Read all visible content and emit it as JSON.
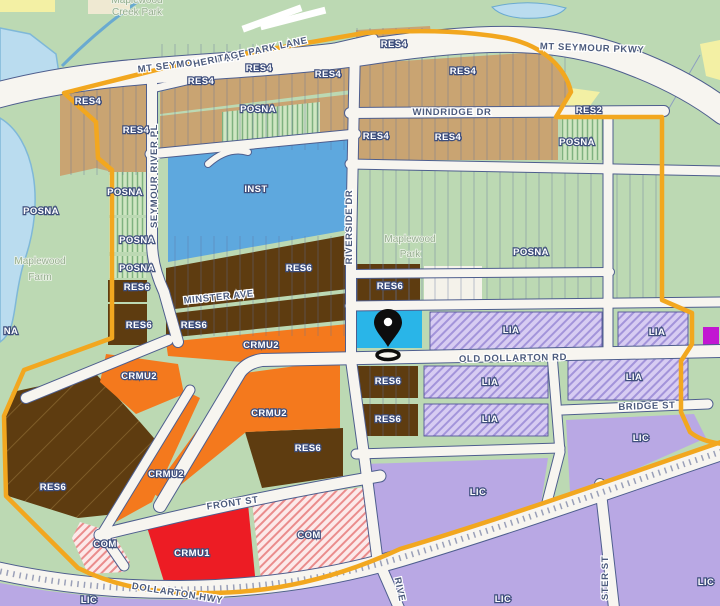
{
  "map": {
    "marker": {
      "name": "selected-parcel-pin",
      "x": 388,
      "y": 325
    },
    "colors": {
      "boundary": "#f2a71f",
      "base_green": "#bcd9b3",
      "water": "#badcef",
      "res4_tan": "#c9a472",
      "inst_blue": "#5ea8de",
      "res6_brown": "#5e3c10",
      "crmu2_orange": "#f4791d",
      "crmu1_red": "#ed1c24",
      "lia_purple": "#d7ccf2",
      "lic_purple": "#b9a8e4",
      "com_pink": "#fce9e9",
      "selected_cyan": "#29b5e8",
      "magenta": "#c217d2",
      "yellow": "#f3f0a4",
      "white_parcel": "#f4f2ea"
    },
    "zone_labels": [
      {
        "t": "RES4",
        "x": 88,
        "y": 104
      },
      {
        "t": "RES4",
        "x": 136,
        "y": 133
      },
      {
        "t": "RES4",
        "x": 201,
        "y": 84
      },
      {
        "t": "RES4",
        "x": 259,
        "y": 71
      },
      {
        "t": "RES4",
        "x": 328,
        "y": 77
      },
      {
        "t": "RES4",
        "x": 394,
        "y": 47
      },
      {
        "t": "RES4",
        "x": 463,
        "y": 74
      },
      {
        "t": "RES4",
        "x": 376,
        "y": 139
      },
      {
        "t": "RES4",
        "x": 448,
        "y": 140
      },
      {
        "t": "RES2",
        "x": 589,
        "y": 113
      },
      {
        "t": "POSNA",
        "x": 258,
        "y": 112
      },
      {
        "t": "POSNA",
        "x": 577,
        "y": 145
      },
      {
        "t": "POSNA",
        "x": 41,
        "y": 214,
        "size": 11
      },
      {
        "t": "POSNA",
        "x": 125,
        "y": 195
      },
      {
        "t": "POSNA",
        "x": 137,
        "y": 243
      },
      {
        "t": "POSNA",
        "x": 137,
        "y": 271
      },
      {
        "t": "POSNA",
        "x": 531,
        "y": 255,
        "size": 11
      },
      {
        "t": "NA",
        "x": 11,
        "y": 334
      },
      {
        "t": "RES6",
        "x": 137,
        "y": 290
      },
      {
        "t": "RES6",
        "x": 139,
        "y": 328
      },
      {
        "t": "RES6",
        "x": 194,
        "y": 328
      },
      {
        "t": "RES6",
        "x": 299,
        "y": 271
      },
      {
        "t": "RES6",
        "x": 390,
        "y": 289
      },
      {
        "t": "RES6",
        "x": 388,
        "y": 384
      },
      {
        "t": "RES6",
        "x": 388,
        "y": 422
      },
      {
        "t": "RES6",
        "x": 308,
        "y": 451
      },
      {
        "t": "RES6",
        "x": 53,
        "y": 490
      },
      {
        "t": "INST",
        "x": 256,
        "y": 192,
        "size": 11
      },
      {
        "t": "CRMU2",
        "x": 139,
        "y": 379
      },
      {
        "t": "CRMU2",
        "x": 261,
        "y": 348
      },
      {
        "t": "CRMU2",
        "x": 269,
        "y": 416
      },
      {
        "t": "CRMU2",
        "x": 166,
        "y": 477
      },
      {
        "t": "CRMU1",
        "x": 192,
        "y": 556
      },
      {
        "t": "COM",
        "x": 105,
        "y": 547
      },
      {
        "t": "COM",
        "x": 309,
        "y": 538
      },
      {
        "t": "LIA",
        "x": 511,
        "y": 333
      },
      {
        "t": "LIA",
        "x": 657,
        "y": 335
      },
      {
        "t": "LIA",
        "x": 490,
        "y": 385
      },
      {
        "t": "LIA",
        "x": 490,
        "y": 422
      },
      {
        "t": "LIA",
        "x": 634,
        "y": 380
      },
      {
        "t": "LIC",
        "x": 478,
        "y": 495,
        "size": 11
      },
      {
        "t": "LIC",
        "x": 641,
        "y": 441,
        "size": 11
      },
      {
        "t": "LIC",
        "x": 89,
        "y": 603,
        "size": 8
      },
      {
        "t": "LIC",
        "x": 503,
        "y": 602,
        "size": 11
      },
      {
        "t": "LIC",
        "x": 706,
        "y": 585,
        "size": 11
      }
    ],
    "street_labels": [
      {
        "t": "MT SEYMOUR PKWY",
        "x": 190,
        "y": 66,
        "r": -7,
        "size": 12
      },
      {
        "t": "MT SEYMOUR PKWY",
        "x": 592,
        "y": 51,
        "r": 2,
        "size": 12
      },
      {
        "t": "HERITAGE PARK LANE",
        "x": 251,
        "y": 55,
        "r": -12,
        "size": 9
      },
      {
        "t": "WINDRIDGE DR",
        "x": 452,
        "y": 115,
        "r": 0,
        "size": 10
      },
      {
        "t": "SEYMOUR RIVER PL",
        "x": 157,
        "y": 176,
        "r": -90,
        "size": 9
      },
      {
        "t": "RIVERSIDE DR",
        "x": 352,
        "y": 227,
        "r": -90,
        "size": 9
      },
      {
        "t": "MINSTER AVE",
        "x": 219,
        "y": 300,
        "r": -6,
        "size": 9
      },
      {
        "t": "OLD DOLLARTON RD",
        "x": 513,
        "y": 361,
        "r": -1,
        "size": 10.5
      },
      {
        "t": "BRIDGE ST",
        "x": 647,
        "y": 409,
        "r": -2,
        "size": 10
      },
      {
        "t": "FRONT ST",
        "x": 233,
        "y": 506,
        "r": -8,
        "size": 10
      },
      {
        "t": "DOLLARTON HWY",
        "x": 177,
        "y": 596,
        "r": 9,
        "size": 12
      },
      {
        "t": "RIVE",
        "x": 397,
        "y": 590,
        "r": 78,
        "size": 9
      },
      {
        "t": "STER ST",
        "x": 608,
        "y": 578,
        "r": -90,
        "size": 9
      }
    ],
    "place_labels": [
      {
        "t": "Maplewood",
        "x": 137,
        "y": 3
      },
      {
        "t": "Creek Park",
        "x": 137,
        "y": 15
      },
      {
        "t": "Maplewood",
        "x": 410,
        "y": 242
      },
      {
        "t": "Park",
        "x": 410,
        "y": 257
      },
      {
        "t": "Maplewood",
        "x": 40,
        "y": 264
      },
      {
        "t": "Farm",
        "x": 40,
        "y": 280
      }
    ]
  }
}
